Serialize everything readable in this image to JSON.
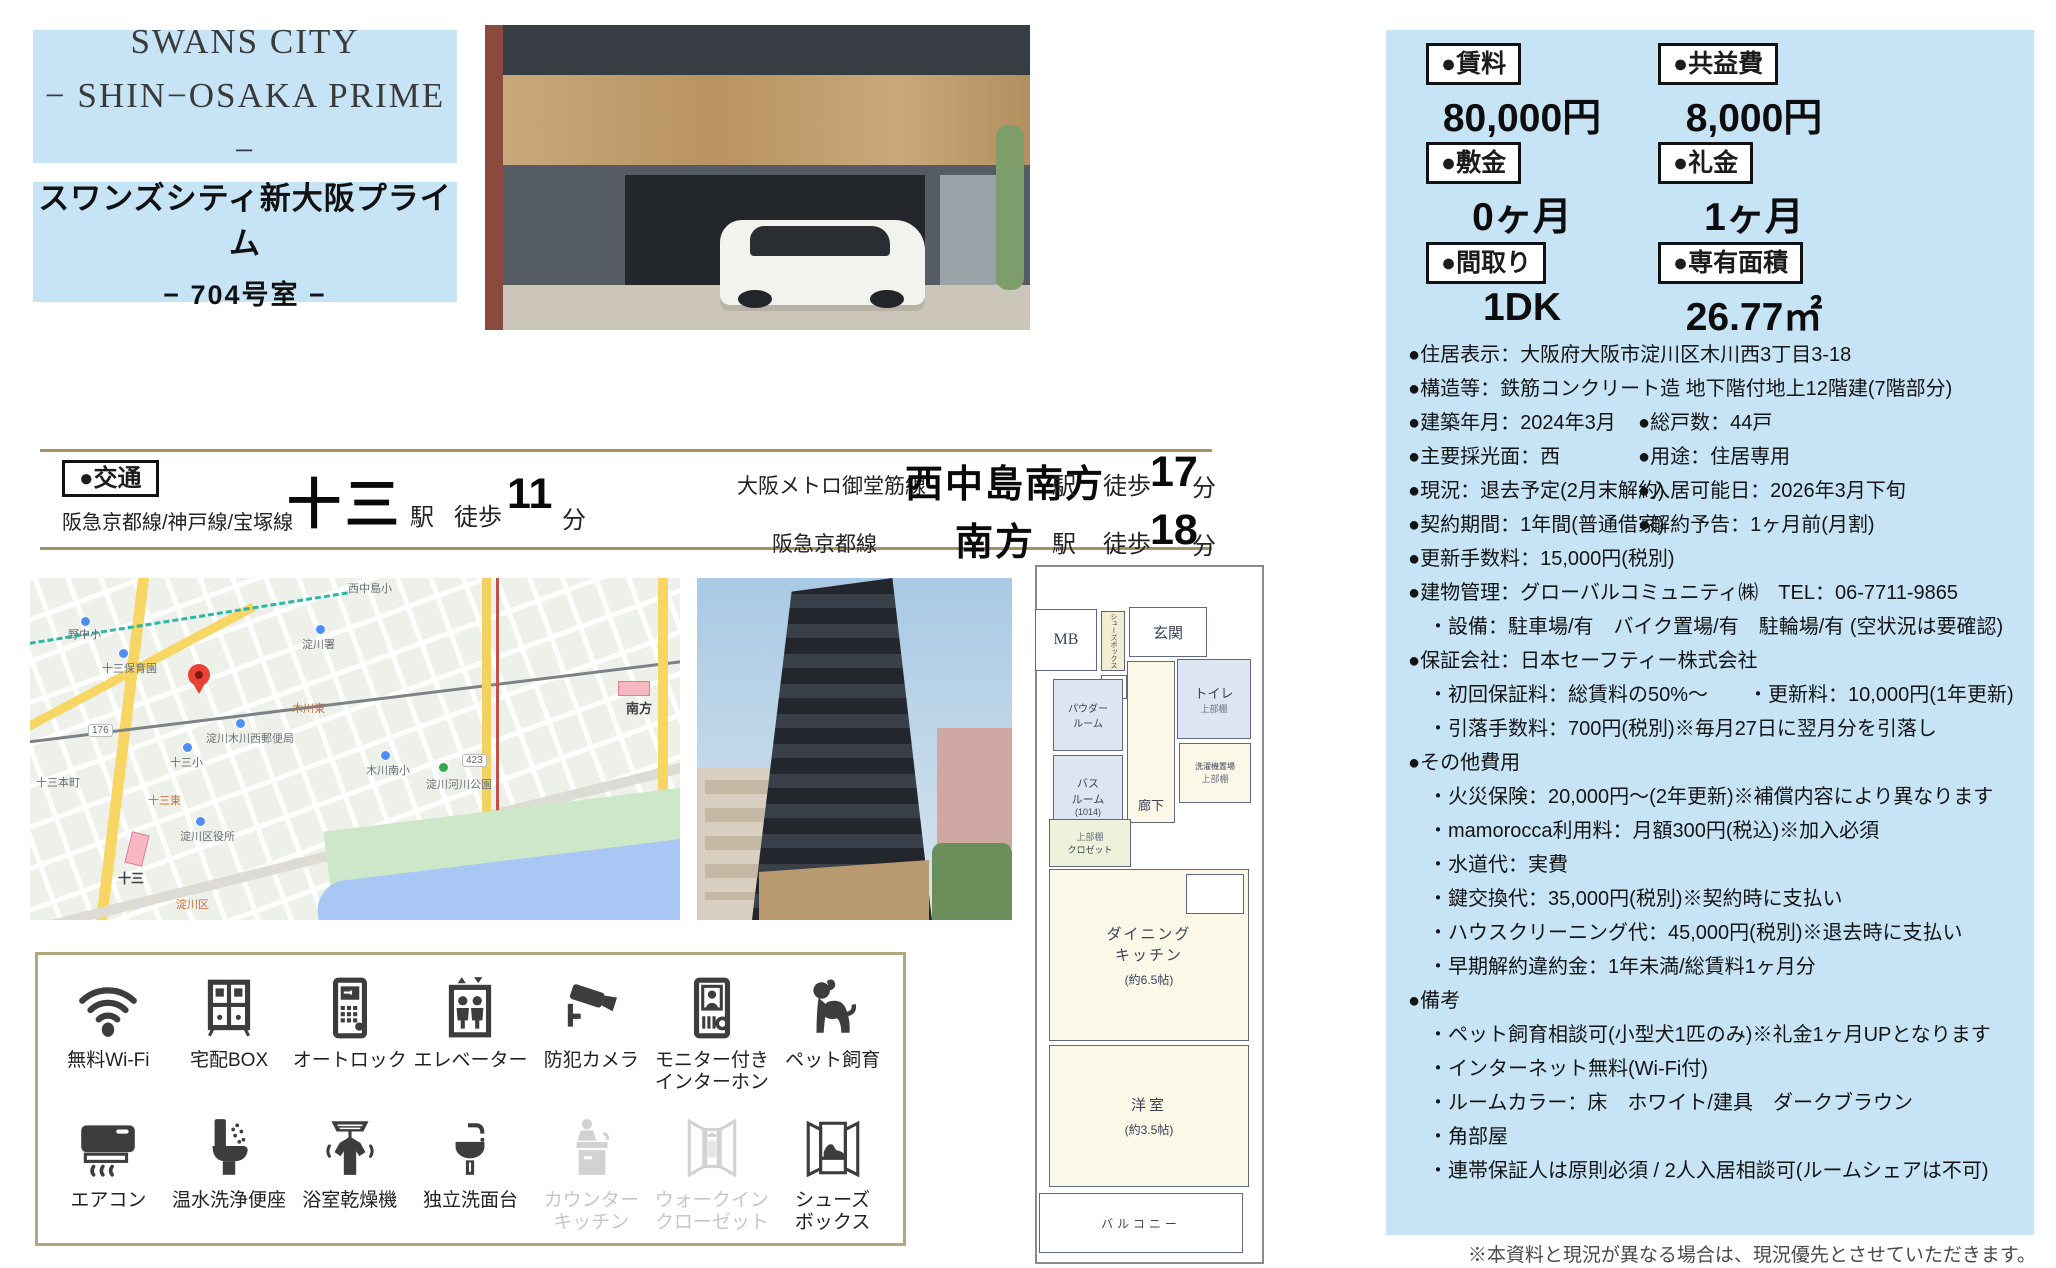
{
  "title": {
    "en_line1": "SWANS CITY",
    "en_line2": "− SHIN−OSAKA PRIME −",
    "ja_name": "スワンズシティ新大阪プライム",
    "room": "− 704号室 −"
  },
  "summary": {
    "pairs": [
      {
        "label": "●賃料",
        "value": "80,000円"
      },
      {
        "label": "●共益費",
        "value": "8,000円"
      },
      {
        "label": "●敷金",
        "value": "0ヶ月"
      },
      {
        "label": "●礼金",
        "value": "1ヶ月"
      },
      {
        "label": "●間取り",
        "value": "1DK"
      },
      {
        "label": "●専有面積",
        "value": "26.77㎡"
      }
    ]
  },
  "details": [
    {
      "left": "●住居表示：大阪府大阪市淀川区木川西3丁目3-18"
    },
    {
      "left": "●構造等：鉄筋コンクリート造 地下階付地上12階建(7階部分)"
    },
    {
      "left": "●建築年月：2024年3月",
      "right": "●総戸数：44戸"
    },
    {
      "left": "●主要採光面：西",
      "right": "●用途：住居専用"
    },
    {
      "left": "●現況：退去予定(2月末解約)",
      "right": "●入居可能日：2026年3月下旬"
    },
    {
      "left": "●契約期間：1年間(普通借家)",
      "right": "●解約予告：1ヶ月前(月割)"
    },
    {
      "left": "●更新手数料：15,000円(税別)"
    },
    {
      "left": "●建物管理：グローバルコミュニティ㈱　TEL：06-7711-9865"
    },
    {
      "left": "　・設備：駐車場/有　バイク置場/有　駐輪場/有 (空状況は要確認)"
    },
    {
      "left": "●保証会社：日本セーフティー株式会社"
    },
    {
      "left": "　・初回保証料：総賃料の50%～　　・更新料：10,000円(1年更新)"
    },
    {
      "left": "　・引落手数料：700円(税別)※毎月27日に翌月分を引落し"
    },
    {
      "left": "●その他費用"
    },
    {
      "left": "　・火災保険：20,000円～(2年更新)※補償内容により異なります"
    },
    {
      "left": "　・mamorocca利用料：月額300円(税込)※加入必須"
    },
    {
      "left": "　・水道代：実費"
    },
    {
      "left": "　・鍵交換代：35,000円(税別)※契約時に支払い"
    },
    {
      "left": "　・ハウスクリーニング代：45,000円(税別)※退去時に支払い"
    },
    {
      "left": "　・早期解約違約金：1年未満/総賃料1ヶ月分"
    },
    {
      "left": "●備考"
    },
    {
      "left": "　・ペット飼育相談可(小型犬1匹のみ)※礼金1ヶ月UPとなります"
    },
    {
      "left": "　・インターネット無料(Wi-Fi付)"
    },
    {
      "left": "　・ルームカラー：床　ホワイト/建具　ダークブラウン"
    },
    {
      "left": "　・角部屋"
    },
    {
      "left": "　・連帯保証人は原則必須 / 2人入居相談可(ルームシェアは不可)"
    }
  ],
  "transport": {
    "section_label": "●交通",
    "routes": [
      {
        "line": "阪急京都線/神戸線/宝塚線",
        "station": "十三",
        "suffix": "駅",
        "walk": "徒歩",
        "minutes": "11",
        "unit": "分"
      },
      {
        "line": "大阪メトロ御堂筋線",
        "station": "西中島南方",
        "suffix": "駅",
        "walk": "徒歩",
        "minutes": "17",
        "unit": "分"
      },
      {
        "line": "阪急京都線",
        "station": "南方",
        "suffix": "駅",
        "walk": "徒歩",
        "minutes": "18",
        "unit": "分"
      }
    ]
  },
  "amenities": [
    {
      "label": "無料Wi-Fi",
      "icon": "wifi-icon",
      "active": true
    },
    {
      "label": "宅配BOX",
      "icon": "delivery-box-icon",
      "active": true
    },
    {
      "label": "オートロック",
      "icon": "autolock-icon",
      "active": true
    },
    {
      "label": "エレベーター",
      "icon": "elevator-icon",
      "active": true
    },
    {
      "label": "防犯カメラ",
      "icon": "security-camera-icon",
      "active": true
    },
    {
      "label": "モニター付き\nインターホン",
      "icon": "intercom-icon",
      "active": true
    },
    {
      "label": "ペット飼育",
      "icon": "pet-icon",
      "active": true
    },
    {
      "label": "エアコン",
      "icon": "aircon-icon",
      "active": true
    },
    {
      "label": "温水洗浄便座",
      "icon": "washlet-icon",
      "active": true
    },
    {
      "label": "浴室乾燥機",
      "icon": "bath-dryer-icon",
      "active": true
    },
    {
      "label": "独立洗面台",
      "icon": "sink-icon",
      "active": true
    },
    {
      "label": "カウンター\nキッチン",
      "icon": "counter-kitchen-icon",
      "active": false
    },
    {
      "label": "ウォークイン\nクローゼット",
      "icon": "walk-in-closet-icon",
      "active": false
    },
    {
      "label": "シューズ\nボックス",
      "icon": "shoebox-icon",
      "active": true
    }
  ],
  "floorplan": {
    "mb": "MB",
    "shoes": "シューズボックス",
    "entrance": "玄関",
    "ps": "PS",
    "toilet": "トイレ",
    "shelf_note": "上部棚",
    "powder": "パウダー\nルーム",
    "bath": "バス\nルーム",
    "bath_size": "(1014)",
    "corridor": "廊下",
    "laundry": "洗濯機置場",
    "closet": "クロゼット",
    "dk_line1": "ダイニング",
    "dk_line2": "キッチン",
    "dk_size": "(約6.5帖)",
    "bedroom": "洋室",
    "bedroom_size": "(約3.5帖)",
    "balcony": "バルコニー"
  },
  "map": {
    "labels": [
      "野中小",
      "十三保育園",
      "西中島小",
      "淀川署",
      "木川東",
      "淀川木川西郵便局",
      "十三小",
      "十三東",
      "木川南小",
      "淀川河川公園",
      "淀川区役所",
      "十三本町",
      "淀川区",
      "十三",
      "南方",
      "176",
      "423"
    ]
  },
  "footer_note": "※本資料と現況が異なる場合は、現況優先とさせていただきます。"
}
